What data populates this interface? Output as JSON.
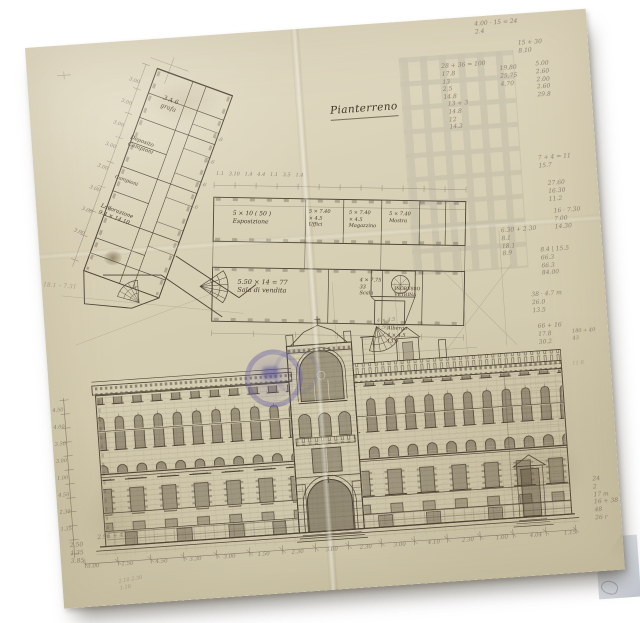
{
  "colors": {
    "background": "#ffffff",
    "paper": "#d8d0b5",
    "ink": "#453a2b",
    "pencil": "#84796a",
    "stamp_blue": "#6862a4"
  },
  "plan": {
    "title": "Pianterreno"
  },
  "rooms": {
    "esposizione": "5 × 10 ( 50 )\nEsposizione",
    "uffici": "5 × 7.40\n× 4.5\nUffici",
    "magazzino": "5 × 7.40\n× 4.5\nMagazzino",
    "mostra": "5 × 7.40\nMostra",
    "sala": "5.50 × 14 = 77\nSala di vendita",
    "scala": "4 × 7.75\n33\nScala",
    "ingresso": "INGRESSO\nVETRINA",
    "albergo": "Albergo\n4 × 4.5\n13.0",
    "wing_a": "3 A 6\ngrafa",
    "wing_b": "Deposito\nCampioni",
    "wing_c": "Campioni",
    "wing_d": "Lavorazione\n9.4 × 14.10"
  },
  "annotations": {
    "calc_a": "4.00 · 15 = 24\n2.4",
    "calc_b": "15 + 30\n8.10",
    "calc_c": "28 + 36 = 100\n17.8\n13\n2.5\n14.8",
    "calc_d": "19,80\n25,75\n4,70",
    "calc_e": "5.00\n2.60\n2.00\n2.60\n29.8",
    "calc_f": "13 + 3\n14.8\n12\n14.3",
    "calc_g": "7 + 4 = 11\n15.7",
    "calc_h": "27.60\n16.30\n11.2",
    "calc_i": "16 · 7.30\n7.00\n14.30",
    "calc_j": "6.30 + 2.30\n8.1\n18.1\n8.9",
    "calc_k": "8.4 | 15.5\n66.3\n66.3\n84.00",
    "calc_l": "38 · 4.7 m\n26.0\n13.5",
    "calc_m": "66 + 16\n17.8\n30.2",
    "calc_n": "180 + 40\n43",
    "calc_o": "24\n2\n17 m\n16 + 38\n48\n26 r",
    "calc_p": "2.50\n1.35\n3.85",
    "note_q": "2.96 + 4.35 y",
    "note_r": "18.1 – 7.31",
    "note_t": "4 × 4.5\n1.50",
    "note_iib": "11 B",
    "scribble_bl": "2.10  2.30\n1.10"
  },
  "dims": {
    "top_line": "1.1   3.10   1.4   4.4   1.1   3.5   1.4",
    "wing_left": "3.00\n3.00\n3.00\n3.00\n3.00\n3.00\n3.00\n3.00",
    "wing_right": "4.8\n2.6\n3.6\n2.6",
    "left_column": "4.50\n4.00\n3.50\n3.00\n1.00\n4.50\n2.30\n1.35",
    "bottom_row": [
      "3.00",
      "1.50",
      "4.50",
      "3.30",
      "3.00",
      "1.50",
      "2.30",
      "3.00",
      "2.30",
      "3.00",
      "4.10",
      "2.30",
      "1.00",
      "4.04",
      "1.15"
    ]
  }
}
